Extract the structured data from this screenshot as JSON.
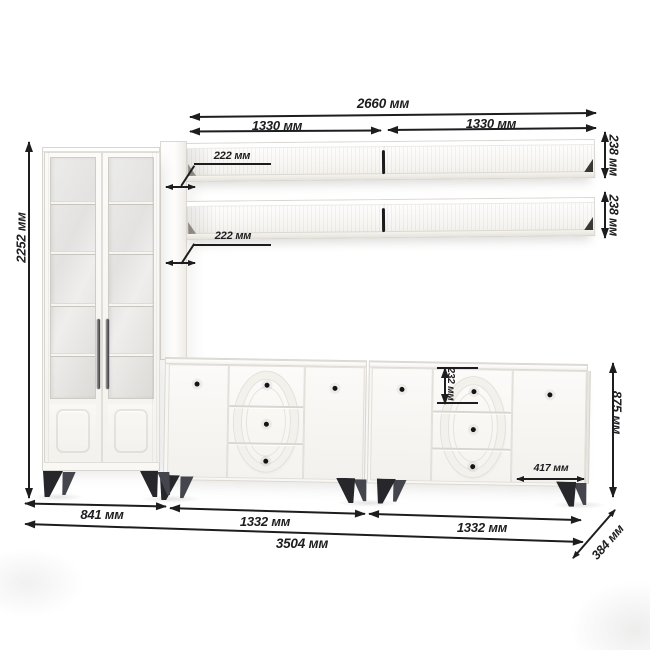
{
  "colors": {
    "ink": "#1d1d1f",
    "furniture": "#f8f6f3",
    "legs": "#26262b",
    "background": "#ffffff"
  },
  "dims": {
    "cabinet_height": "2252 мм",
    "shelf_total_width": "2660 мм",
    "shelf_width_left": "1330 мм",
    "shelf_width_right": "1330 мм",
    "shelf_depth_top": "222 мм",
    "shelf_depth_bottom": "222 мм",
    "shelf_height_top": "238 мм",
    "shelf_height_bottom": "238 мм",
    "cabinet_width": "841 мм",
    "sideboard_width_left": "1332 мм",
    "sideboard_width_right": "1332 мм",
    "total_width": "3504 мм",
    "sideboard_height": "875 мм",
    "sideboard_depth": "384 мм",
    "drawer_height": "232 мм",
    "door_width": "417 мм"
  }
}
